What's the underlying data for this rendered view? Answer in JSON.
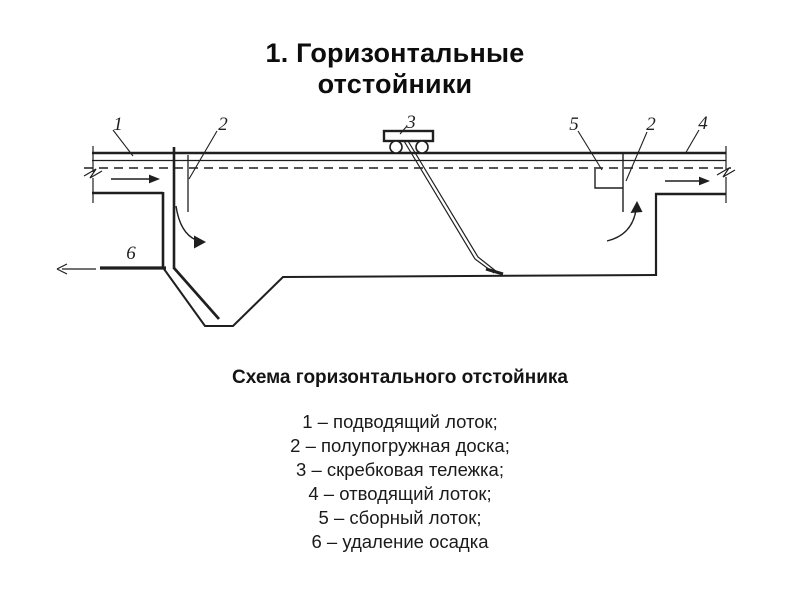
{
  "slide": {
    "title_line1": "1. Горизонтальные",
    "title_line2": "отстойники",
    "caption": "Схема горизонтального отстойника"
  },
  "legend": {
    "items": [
      "1 – подводящий лоток;",
      "2 – полупогружная доска;",
      "3 – скребковая тележка;",
      "4 – отводящий лоток;",
      "5 – сборный лоток;",
      "6 – удаление осадка"
    ]
  },
  "diagram": {
    "labels": {
      "inlet": "1",
      "baffle_left": "2",
      "trolley": "3",
      "collector": "5",
      "baffle_right": "2",
      "outlet": "4",
      "sludge": "6"
    },
    "colors": {
      "ink": "#1f1f1f",
      "background": "#ffffff"
    }
  }
}
